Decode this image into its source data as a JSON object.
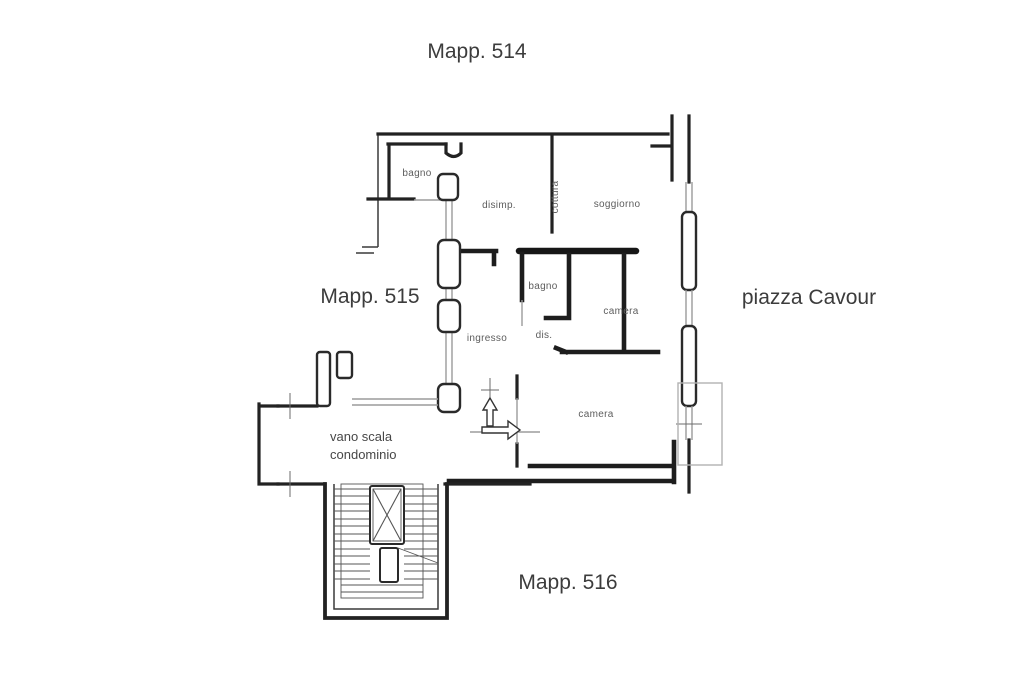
{
  "figure": {
    "type": "floor-plan",
    "description_visible_text_only": true
  },
  "exterior_labels": {
    "top": "Mapp. 514",
    "left": "Mapp. 515",
    "right": "piazza Cavour",
    "bottom": "Mapp. 516"
  },
  "rooms": {
    "bagno_nw": "bagno",
    "disimp": "disimp.",
    "cottura": "cottura",
    "soggiorno": "soggiorno",
    "bagno_center": "bagno",
    "camera_east": "camera",
    "ingresso": "ingresso",
    "dis": "dis.",
    "camera_south": "camera",
    "vano_scala_line1": "vano scala",
    "vano_scala_line2": "condominio"
  },
  "icons": {
    "elevator_shaft": "elevator-shaft-x",
    "entrance_up_arrow": "entrance-direction-up-arrow",
    "entrance_right_arrow": "entrance-direction-right-arrow"
  },
  "colors": {
    "background": "#ffffff",
    "wall": "#222222",
    "wall_heavy": "#161616",
    "window": "#9b9b9b",
    "balcony_outline": "#b2b2b2",
    "label_large": "#3c3c3c",
    "label_small": "#5d5d5d"
  }
}
